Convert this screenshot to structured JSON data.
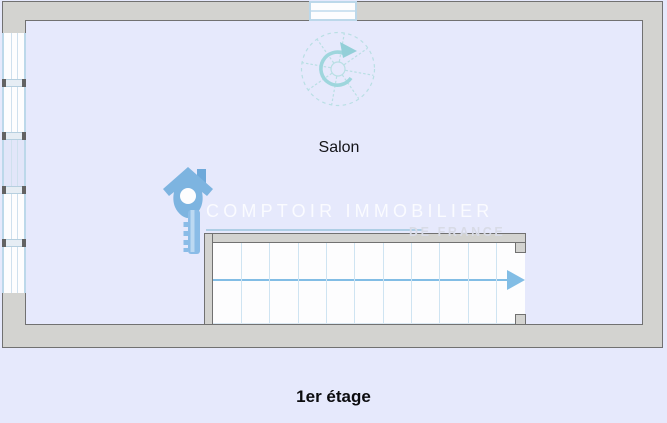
{
  "page": {
    "background_color": "#e6e9fc",
    "floor_label": "1er étage"
  },
  "plan": {
    "room_label": "Salon",
    "stairs": {
      "step_count": 11,
      "direction": "right"
    },
    "left_window": {
      "pane_count": 5,
      "tinted_pane_index": 2
    },
    "spiral_staircase": {
      "arrow_direction": "clockwise"
    },
    "colors": {
      "wall_fill": "#d3d3d0",
      "wall_outline": "#717171",
      "floor_fill": "#e6e9fc",
      "window_frame": "#bcd8ea",
      "window_glass_line": "#cfe0ee",
      "stair_tread_line": "#cfe4f2",
      "stair_arrow": "#82bde5",
      "spiral_symbol": "#aadbe1",
      "spiral_arrow": "#93cfd8",
      "logo_blue": "#7db4e0",
      "watermark_line": "#a3c9e1"
    }
  },
  "watermark": {
    "brand": "COMPTOIR IMMOBILIER",
    "subbrand": "DE FRANCE"
  }
}
